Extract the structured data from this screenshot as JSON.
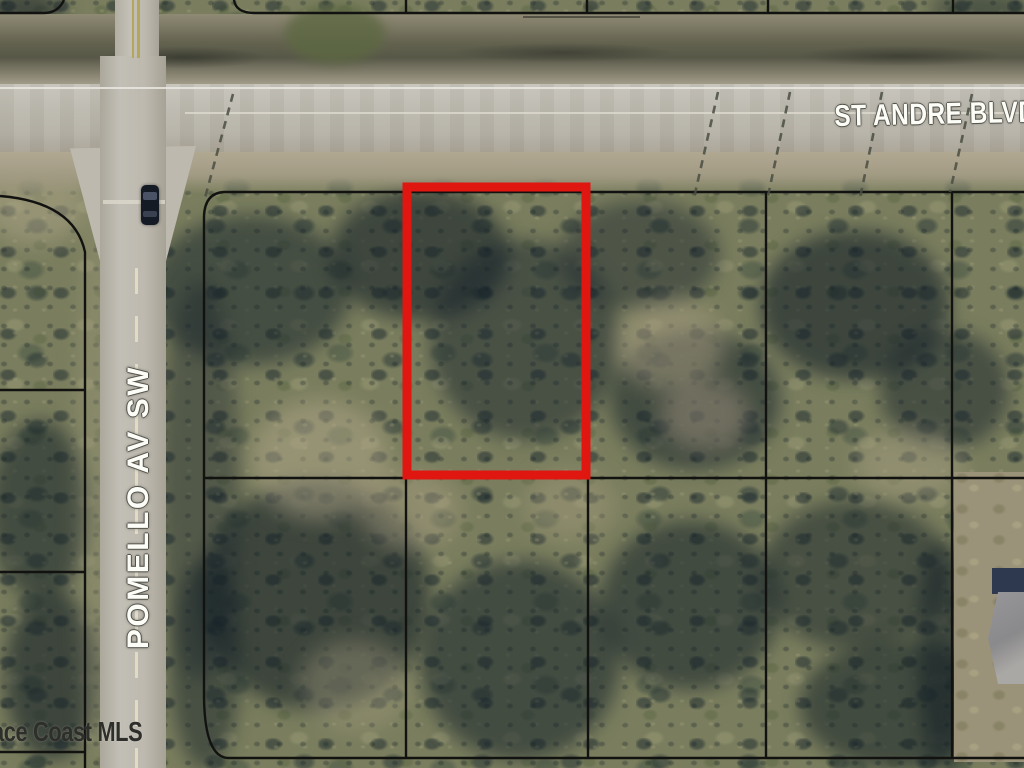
{
  "map": {
    "type": "aerial-parcel-map",
    "roads": {
      "horizontal": {
        "label": "ST ANDRE BLVD"
      },
      "vertical": {
        "label": "POMELLO AV SW"
      }
    },
    "watermark": {
      "text": "ace Coast MLS"
    },
    "highlight": {
      "color": "#e01610",
      "description": "red outline around listed vacant parcel"
    },
    "colors": {
      "pavement": "#bbb8ae",
      "shoulder": "#a89f8a",
      "vegetation": "#7a7e5e",
      "tree_shadow": "#1f2e36",
      "parcel_line": "#121210"
    }
  }
}
